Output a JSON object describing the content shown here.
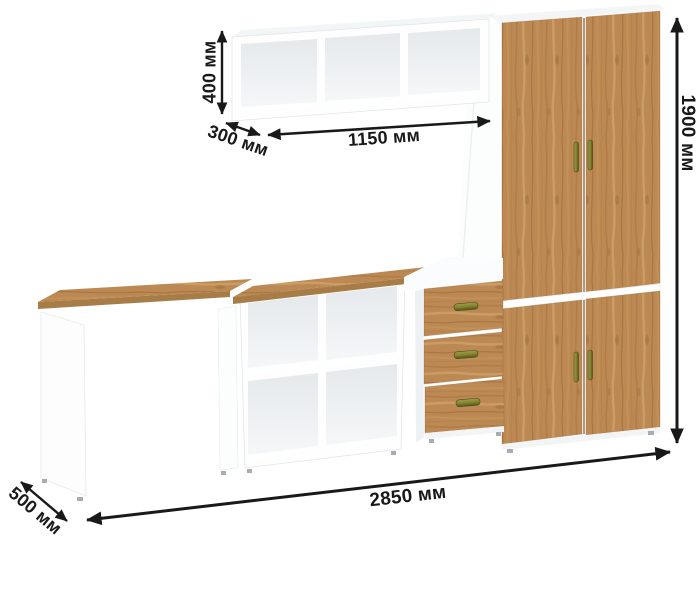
{
  "dimensions": {
    "shelf_height": "400 мм",
    "shelf_depth": "300 мм",
    "shelf_width": "1150 мм",
    "cabinet_height": "1900 мм",
    "total_width": "2850 мм",
    "desk_depth": "500 мм"
  },
  "colors": {
    "wood": "#bc8954",
    "wood_light": "#d4a76c",
    "wood_dark": "#96622f",
    "carcass_white": "#fefefe",
    "interior_shade": "#e7ebee",
    "handle_brass": "#7d7d32",
    "annotation": "#191919"
  }
}
